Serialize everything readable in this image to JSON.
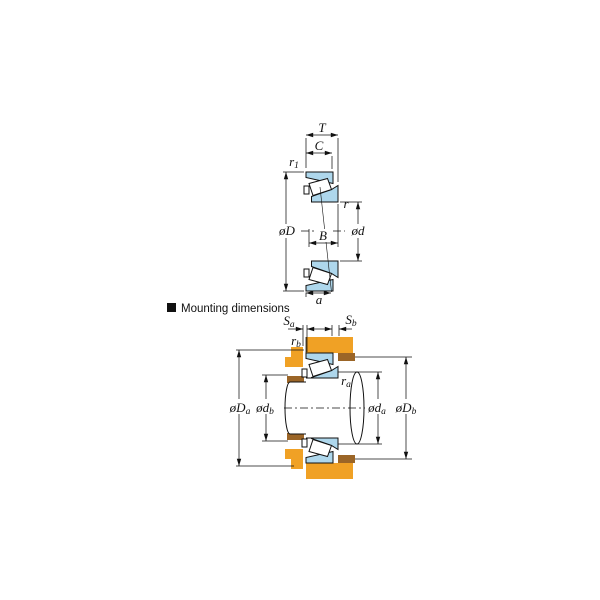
{
  "header": {
    "text": "Mounting dimensions"
  },
  "colors": {
    "bearing_blue": "#aed7ec",
    "housing_orange": "#f0a125",
    "spacer_brown": "#9b6527",
    "line": "#111111",
    "background": "#ffffff"
  },
  "top_figure": {
    "description": "tapered-roller-bearing-section",
    "labels": {
      "T": {
        "main": "T",
        "sub": ""
      },
      "C": {
        "main": "C",
        "sub": ""
      },
      "r1": {
        "main": "r",
        "sub": "1"
      },
      "outer_diameter": {
        "main": "øD",
        "sub": ""
      },
      "bore_diameter": {
        "main": "ød",
        "sub": ""
      },
      "r": {
        "main": "r",
        "sub": ""
      },
      "B": {
        "main": "B",
        "sub": ""
      },
      "a": {
        "main": "a",
        "sub": ""
      }
    }
  },
  "bottom_figure": {
    "description": "mounting-dimensions-section",
    "labels": {
      "Sa": {
        "main": "S",
        "sub": "a"
      },
      "Sb": {
        "main": "S",
        "sub": "b"
      },
      "rb": {
        "main": "r",
        "sub": "b"
      },
      "ra": {
        "main": "r",
        "sub": "a"
      },
      "Da": {
        "main": "øD",
        "sub": "a"
      },
      "db": {
        "main": "ød",
        "sub": "b"
      },
      "da": {
        "main": "ød",
        "sub": "a"
      },
      "Db": {
        "main": "øD",
        "sub": "b"
      }
    }
  }
}
